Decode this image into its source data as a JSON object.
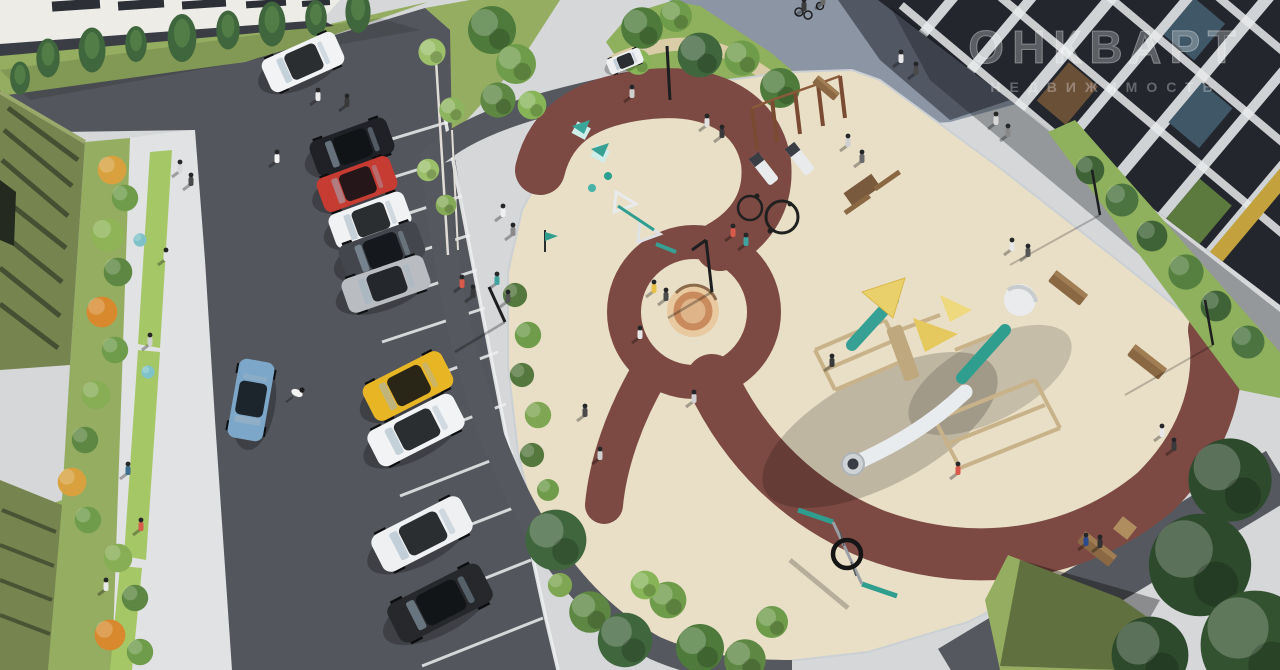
{
  "watermark": {
    "line1": "ОНКВАРТ",
    "line2": "НЕДВИЖИМОСТЬ"
  },
  "palette": {
    "pavement": "#d5d7d9",
    "pavement_bright": "#e1e2e4",
    "asphalt": "#53565c",
    "path_dark": "#55585e",
    "playground_surface": "#e9dfc6",
    "track_maroon": "#7d4a43",
    "sand": "#e8c9a0",
    "grass": "#95ad61",
    "lawn_bright": "#a6c766",
    "park_grass": "#8fb05c",
    "road": "#8b95a4",
    "building_white": "#edece7",
    "building_dark": "#23262d",
    "facade_olive": "#76854f",
    "wood": "#c8b28a",
    "teal_equipment": "#2f9e8f",
    "sail_yellow": "#ead06b",
    "slide_white": "#e9ecee"
  },
  "cars": [
    {
      "name": "white-sedan-driving",
      "color_name": "white",
      "hex": "#f2f3f4"
    },
    {
      "name": "black-suv",
      "color_name": "black",
      "hex": "#1f2126"
    },
    {
      "name": "red-hatchback",
      "color_name": "red",
      "hex": "#c63b32"
    },
    {
      "name": "white-sedan",
      "color_name": "white",
      "hex": "#f1f2f3"
    },
    {
      "name": "graphite-suv",
      "color_name": "graphite",
      "hex": "#43464c"
    },
    {
      "name": "silver-sedan",
      "color_name": "silver",
      "hex": "#b9bdc2"
    },
    {
      "name": "yellow-hatchback",
      "color_name": "yellow",
      "hex": "#e8b524"
    },
    {
      "name": "white-sedan-2",
      "color_name": "white",
      "hex": "#f2f3f4"
    },
    {
      "name": "white-coupe",
      "color_name": "white",
      "hex": "#eef0f1"
    },
    {
      "name": "black-suv-2",
      "color_name": "black",
      "hex": "#26282c"
    },
    {
      "name": "blue-hatchback",
      "color_name": "light-blue",
      "hex": "#7da7c9"
    },
    {
      "name": "white-city-car",
      "color_name": "white",
      "hex": "#eef0f1"
    }
  ],
  "playground": {
    "surface": "beige rubber with maroon looping track",
    "equipment": [
      "wooden climbing complex with tube slide",
      "twin teal slides",
      "yellow shade sails",
      "round sandbox with circular bench",
      "nest ring swing",
      "workout pull-up bars",
      "incline sit-up benches",
      "teal play houses",
      "balance A-frames",
      "ground game rings",
      "wooden benches",
      "picnic table"
    ]
  },
  "buildings": [
    {
      "name": "white-apartment-block",
      "position": "top-left"
    },
    {
      "name": "dark-brick-apartment-building",
      "position": "top-right"
    },
    {
      "name": "green-facade-structure",
      "position": "left"
    }
  ],
  "scene": {
    "parking_stalls": 12,
    "people_count": 34,
    "dogs": 1,
    "cyclists": 2
  }
}
